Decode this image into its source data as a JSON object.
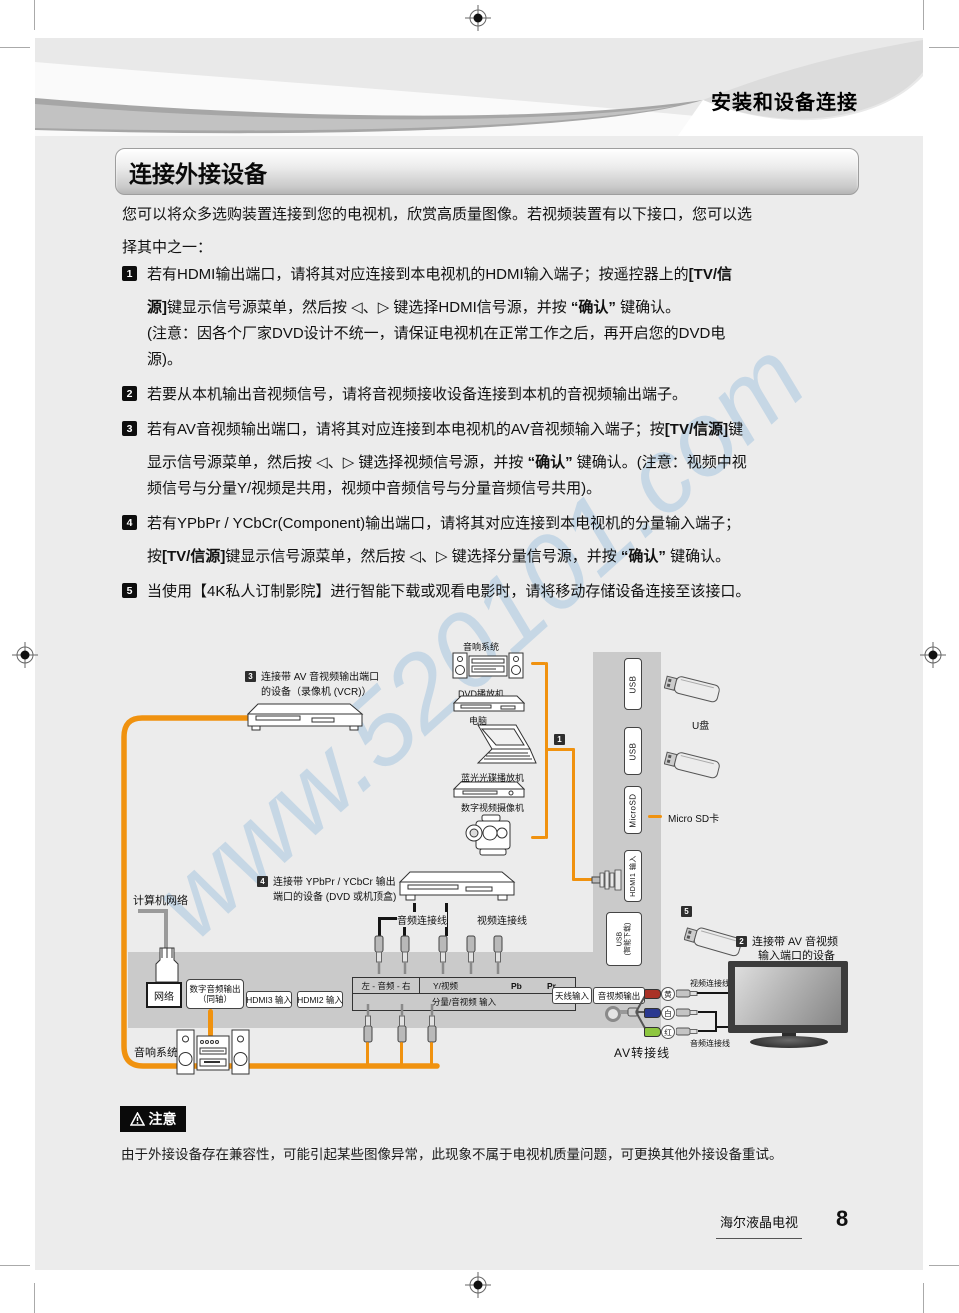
{
  "page": {
    "header_title": "安装和设备连接",
    "section_title": "连接外接设备",
    "intro_line1": "您可以将众多选购装置连接到您的电视机，欣赏高质量图像。若视频装置有以下接口，您可以选",
    "intro_line2": "择其中之一：",
    "watermark": "www.520101.com"
  },
  "list": {
    "items": [
      {
        "num": "1",
        "lines": [
          [
            [
              "若有HDMI输出端口，请将其对应连接到本电视机的HDMI输入端子；按遥控器上的"
            ],
            [
              "[TV/信",
              true
            ]
          ],
          [
            [
              "源]",
              true
            ],
            [
              "键显示信号源菜单，然后按 ◁、▷ 键选择HDMI信号源，并按 "
            ],
            [
              "“确认”",
              true
            ],
            [
              " 键确认。"
            ]
          ],
          [
            [
              "(注意：因各个厂家DVD设计不统一，请保证电视机在正常工作之后，再开启您的DVD电"
            ]
          ],
          [
            [
              "源)。"
            ]
          ]
        ]
      },
      {
        "num": "2",
        "lines": [
          [
            [
              "若要从本机输出音视频信号，请将音视频接收设备连接到本机的音视频输出端子。"
            ]
          ]
        ]
      },
      {
        "num": "3",
        "lines": [
          [
            [
              "若有AV音视频输出端口，请将其对应连接到本电视机的AV音视频输入端子；按"
            ],
            [
              "[TV/信源]",
              true
            ],
            [
              "键"
            ]
          ],
          [
            [
              "显示信号源菜单，然后按 ◁、▷ 键选择视频信号源，并按 "
            ],
            [
              "“确认”",
              true
            ],
            [
              " 键确认。(注意：视频中视"
            ]
          ],
          [
            [
              "频信号与分量Y/视频是共用，视频中音频信号与分量音频信号共用)。"
            ]
          ]
        ]
      },
      {
        "num": "4",
        "lines": [
          [
            [
              "若有YPbPr / YCbCr(Component)输出端口，请将其对应连接到本电视机的分量输入端子；"
            ]
          ],
          [
            [
              "按"
            ],
            [
              "[TV/信源]",
              true
            ],
            [
              "键显示信号源菜单，然后按 ◁、▷ 键选择分量信号源，并按 "
            ],
            [
              "“确认”",
              true
            ],
            [
              " 键确认。"
            ]
          ]
        ]
      },
      {
        "num": "5",
        "lines": [
          [
            [
              "当使用【4K私人订制影院】进行智能下载或观看电影时，请将移动存储设备连接至该接口。"
            ]
          ]
        ]
      }
    ]
  },
  "diagram": {
    "devices": {
      "audio_system_top": "音响系统",
      "dvd_player": "DVD播放机",
      "computer": "电脑",
      "bluray": "蓝光光碟播放机",
      "camcorder": "数字视频摄像机",
      "usb_drive": "U盘",
      "micro_sd": "Micro SD卡",
      "network": "计算机网络",
      "audio_system_bottom": "音响系统"
    },
    "callouts": {
      "c1": "1",
      "c2": "2",
      "c3": "3",
      "c4": "4",
      "c5": "5",
      "c3_line1": "连接带 AV 音视频输出端口",
      "c3_line2": "的设备（录像机 (VCR)）",
      "c4_line1": "连接带 YPbPr / YCbCr 输出",
      "c4_line2": "端口的设备 (DVD 或机顶盒)",
      "c2_line1": "连接带 AV 音视频",
      "c2_line2": "输入端口的设备"
    },
    "ports": {
      "usb": "USB",
      "microsd": "MicroSD",
      "hdmi1": "HDMI1 输入",
      "usb_dl_1": "USB",
      "usb_dl_2": "(智能下载)",
      "network_port": "网络",
      "digital_audio_1": "数字音频输出",
      "digital_audio_2": "（同轴）",
      "hdmi3": "HDMI3 输入",
      "hdmi2": "HDMI2 输入",
      "antenna": "天线输入",
      "av_out": "音视频输出"
    },
    "strip": {
      "row1_left": "左 - 音频 - 右",
      "y_video": "Y/视频",
      "pb": "Pb",
      "pr": "Pr",
      "row2": "分量/音视频  输入"
    },
    "cables": {
      "audio_cable": "音频连接线",
      "video_cable": "视频连接线",
      "video_cable_tv": "视频连接线",
      "audio_cable_tv": "音频连接线",
      "av_adapter": "AV转接线",
      "yellow": "黄",
      "white": "白",
      "red": "红"
    }
  },
  "note": {
    "badge": "注意",
    "text": "由于外接设备存在兼容性，可能引起某些图像异常，此现象不属于电视机质量问题，可更换其他外接设备重试。"
  },
  "footer": {
    "brand": "海尔液晶电视",
    "page_number": "8"
  }
}
